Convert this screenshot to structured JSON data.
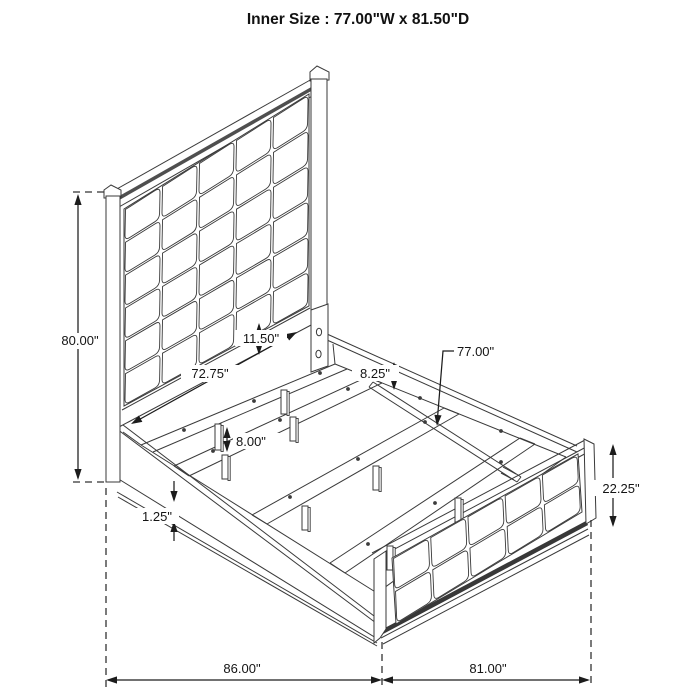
{
  "title": "Inner Size : 77.00\"W x 81.50\"D",
  "dimensions": {
    "overall_height": "80.00\"",
    "headboard_width": "72.75\"",
    "headboard_rail": "11.50\"",
    "rail_to_slat": "8.25\"",
    "slat_length": "77.00\"",
    "leg_height": "8.00\"",
    "rail_trim": "1.25\"",
    "footboard_height": "22.25\"",
    "overall_width": "86.00\"",
    "overall_depth": "81.00\""
  },
  "figure": {
    "background": "#ffffff",
    "line_color": "#3a3a3a",
    "dim_color": "#1c1c1c",
    "headboard_band": "#4f4f4f",
    "footboard_band": "#383838",
    "headboard_grid": {
      "cols": 5,
      "rows": 6
    },
    "footboard_grid": {
      "cols": 5,
      "rows": 2
    }
  }
}
